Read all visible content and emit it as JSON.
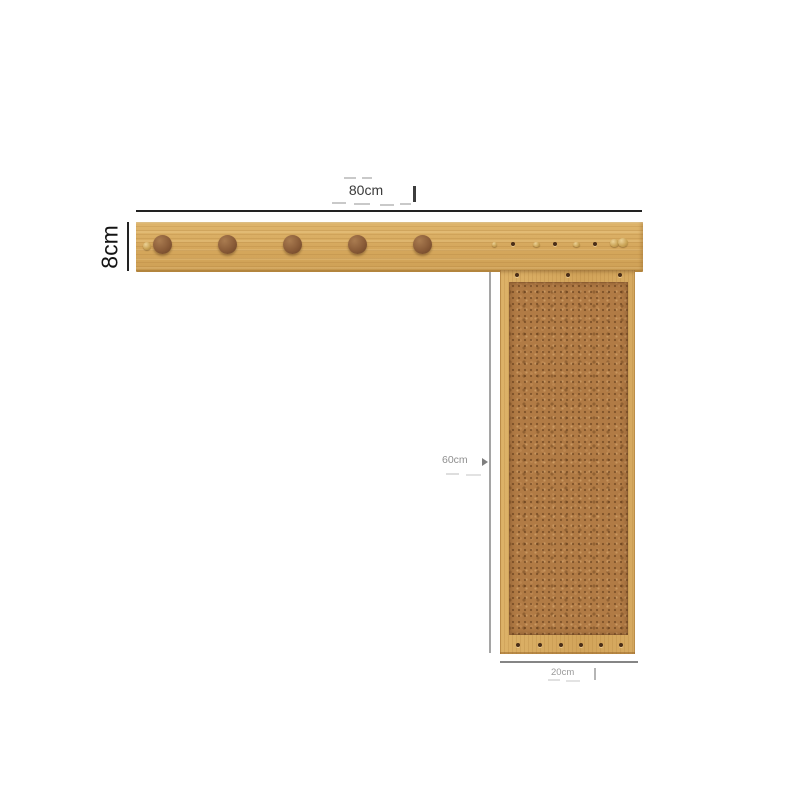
{
  "dimensions": {
    "board_width_label": "80cm",
    "board_height_label": "8cm",
    "panel_height_label": "60cm",
    "panel_width_label": "20cm"
  },
  "product": {
    "board_large_peg_count": 5,
    "board_brass_peg_count": 4,
    "board_small_hole_count": 3,
    "panel_top_hole_count": 3,
    "panel_bottom_hole_count": 6
  },
  "colors": {
    "wood": "#d7aa60",
    "wood_edge": "#b3853d",
    "cork": "#b17b45",
    "peg_wood": "#8a5c38",
    "brass": "#c9a254",
    "dimension_dark": "#222222",
    "dimension_gray": "#9c9c9c",
    "background": "#ffffff"
  }
}
